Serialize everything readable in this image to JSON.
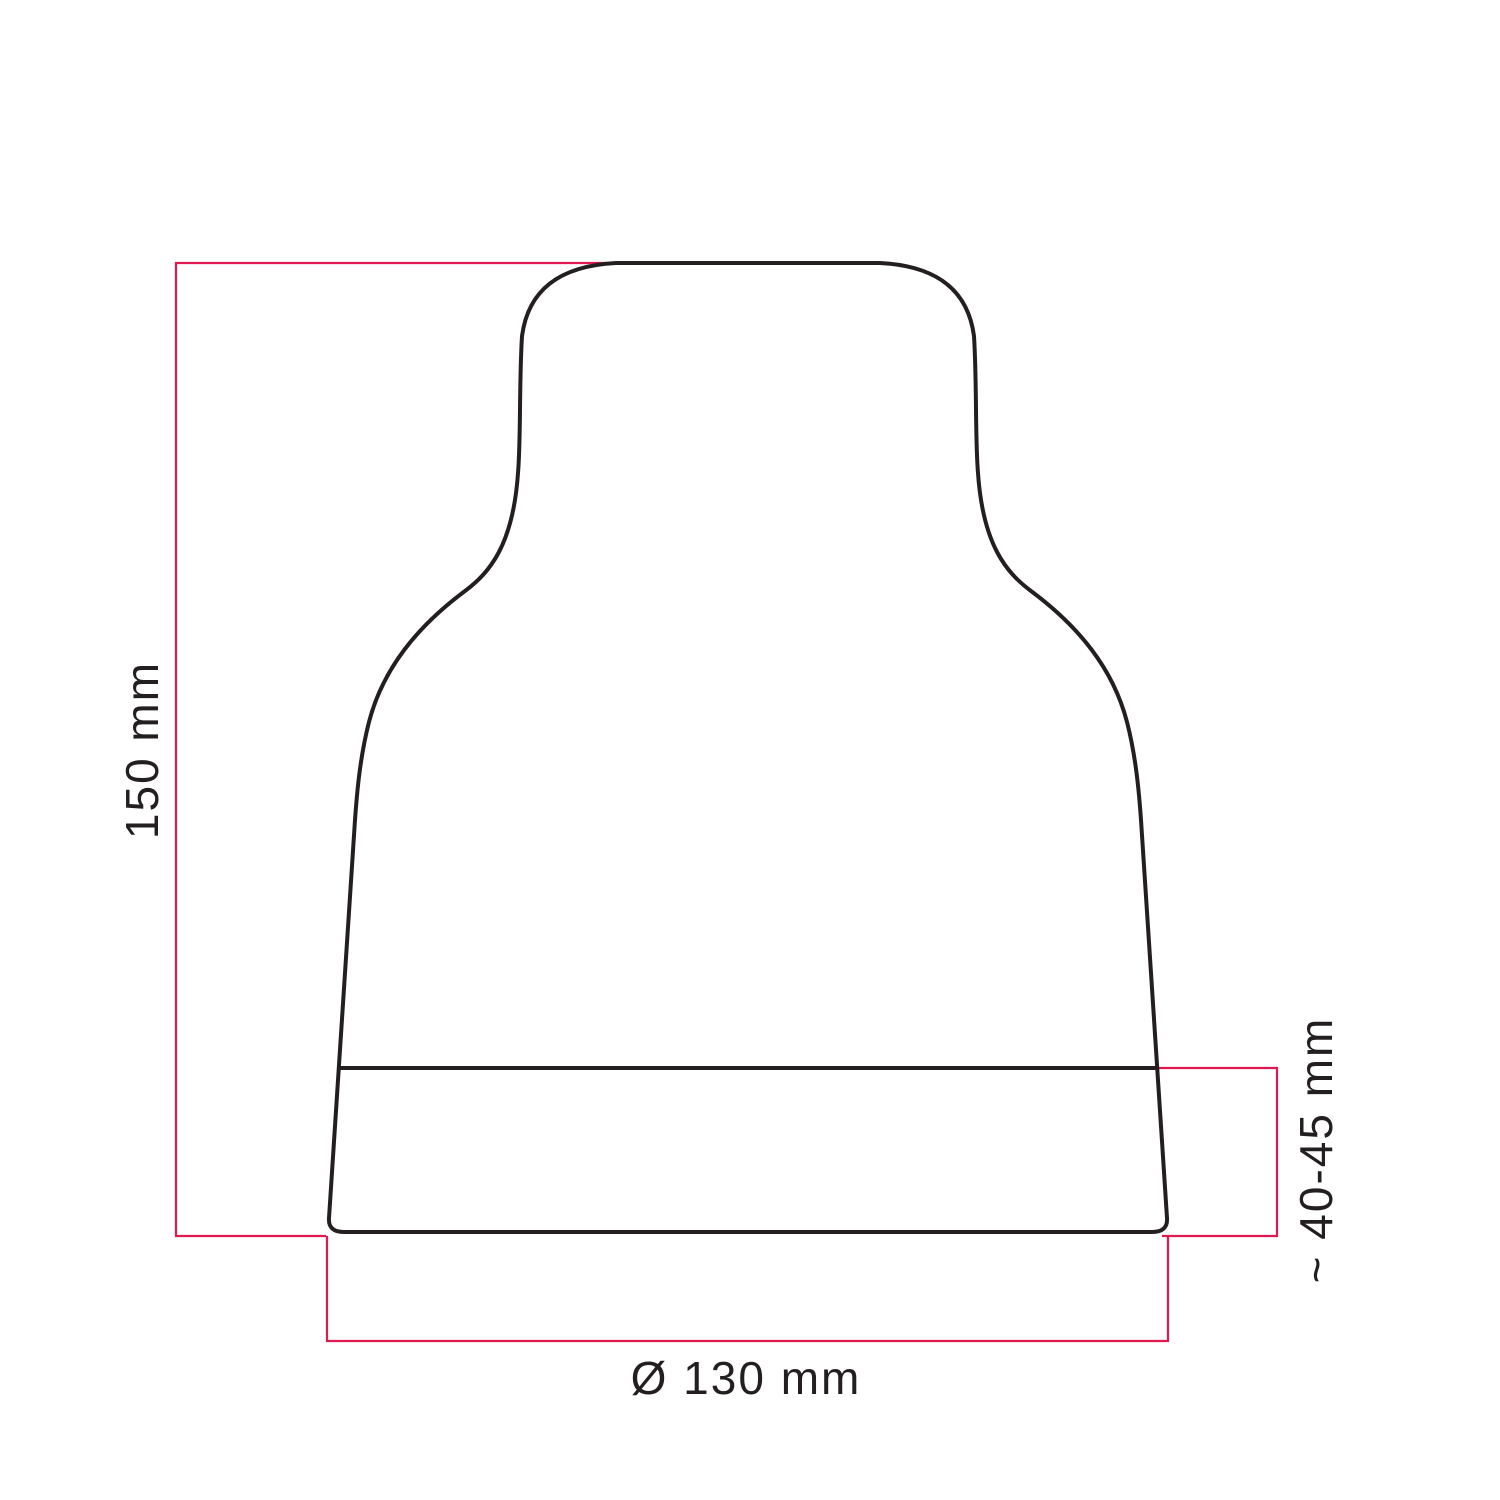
{
  "drawing": {
    "dimensions": {
      "height": {
        "label": "150 mm"
      },
      "base_height": {
        "label": "~ 40-45 mm"
      },
      "diameter": {
        "label": "Ø 130 mm"
      }
    },
    "colors": {
      "outline": "#231f20",
      "dimension_line": "#e01951",
      "label_text": "#231f20"
    }
  }
}
